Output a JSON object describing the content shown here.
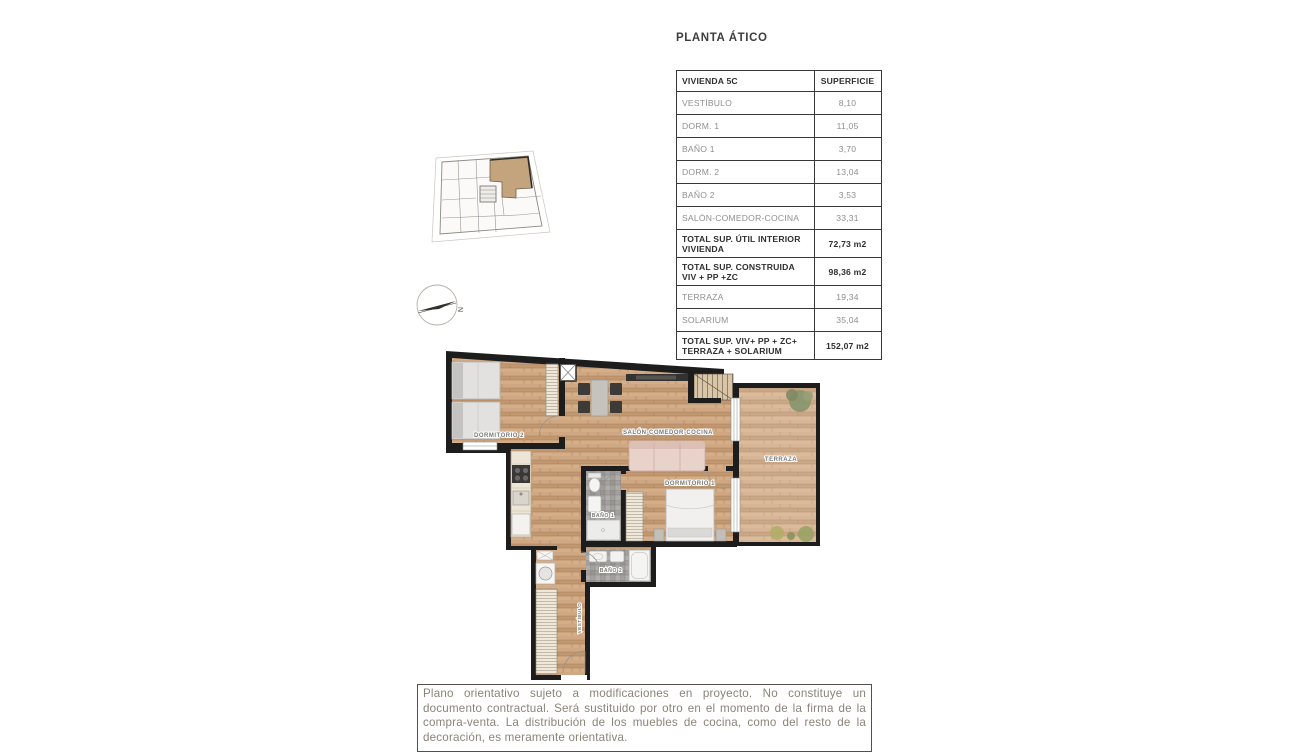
{
  "page": {
    "title": "PLANTA ÁTICO"
  },
  "table": {
    "header": {
      "col1": "VIVIENDA 5C",
      "col2": "SUPERFICIE"
    },
    "rows": [
      {
        "label": "VESTÍBULO",
        "value": "8,10"
      },
      {
        "label": "DORM. 1",
        "value": "11,05"
      },
      {
        "label": "BAÑO 1",
        "value": "3,70"
      },
      {
        "label": "DORM. 2",
        "value": "13,04"
      },
      {
        "label": "BAÑO 2",
        "value": "3,53"
      },
      {
        "label": "SALÓN-COMEDOR-COCINA",
        "value": "33,31"
      },
      {
        "label": "TOTAL SUP. ÚTIL INTERIOR VIVIENDA",
        "value": "72,73 m2"
      },
      {
        "label": "TOTAL SUP. CONSTRUIDA VIV + PP +ZC",
        "value": "98,36 m2"
      },
      {
        "label": "TERRAZA",
        "value": "19,34"
      },
      {
        "label": "SOLARIUM",
        "value": "35,04"
      },
      {
        "label": "TOTAL SUP. VIV+ PP + ZC+ TERRAZA + SOLARIUM",
        "value": "152,07 m2"
      }
    ]
  },
  "floorplan": {
    "labels": {
      "dormitorio2": "DORMITORIO 2",
      "salon": "SALÓN-COMEDOR-COCINA",
      "terraza": "TERRAZA",
      "dormitorio1": "DORMITORIO 1",
      "bano1": "BAÑO 1",
      "bano2": "BAÑO 2",
      "vestibulo": "VESTÍBULO"
    },
    "compass_north": "N"
  },
  "disclaimer": {
    "text": "Plano orientativo sujeto a modificaciones en proyecto. No constituye un documento contractual. Será sustituido por otro en el momento de la firma de la compra-venta. La distribución de los muebles de cocina, como del resto de la decoración, es meramente orientativa."
  },
  "colors": {
    "wall": "#1d1d1d",
    "wood": "#c9a17b",
    "tile": "#a3a19e",
    "unit_highlight": "#c3a47d",
    "text_gray": "#8f8f8f",
    "text_dark": "#2f2f2f"
  }
}
